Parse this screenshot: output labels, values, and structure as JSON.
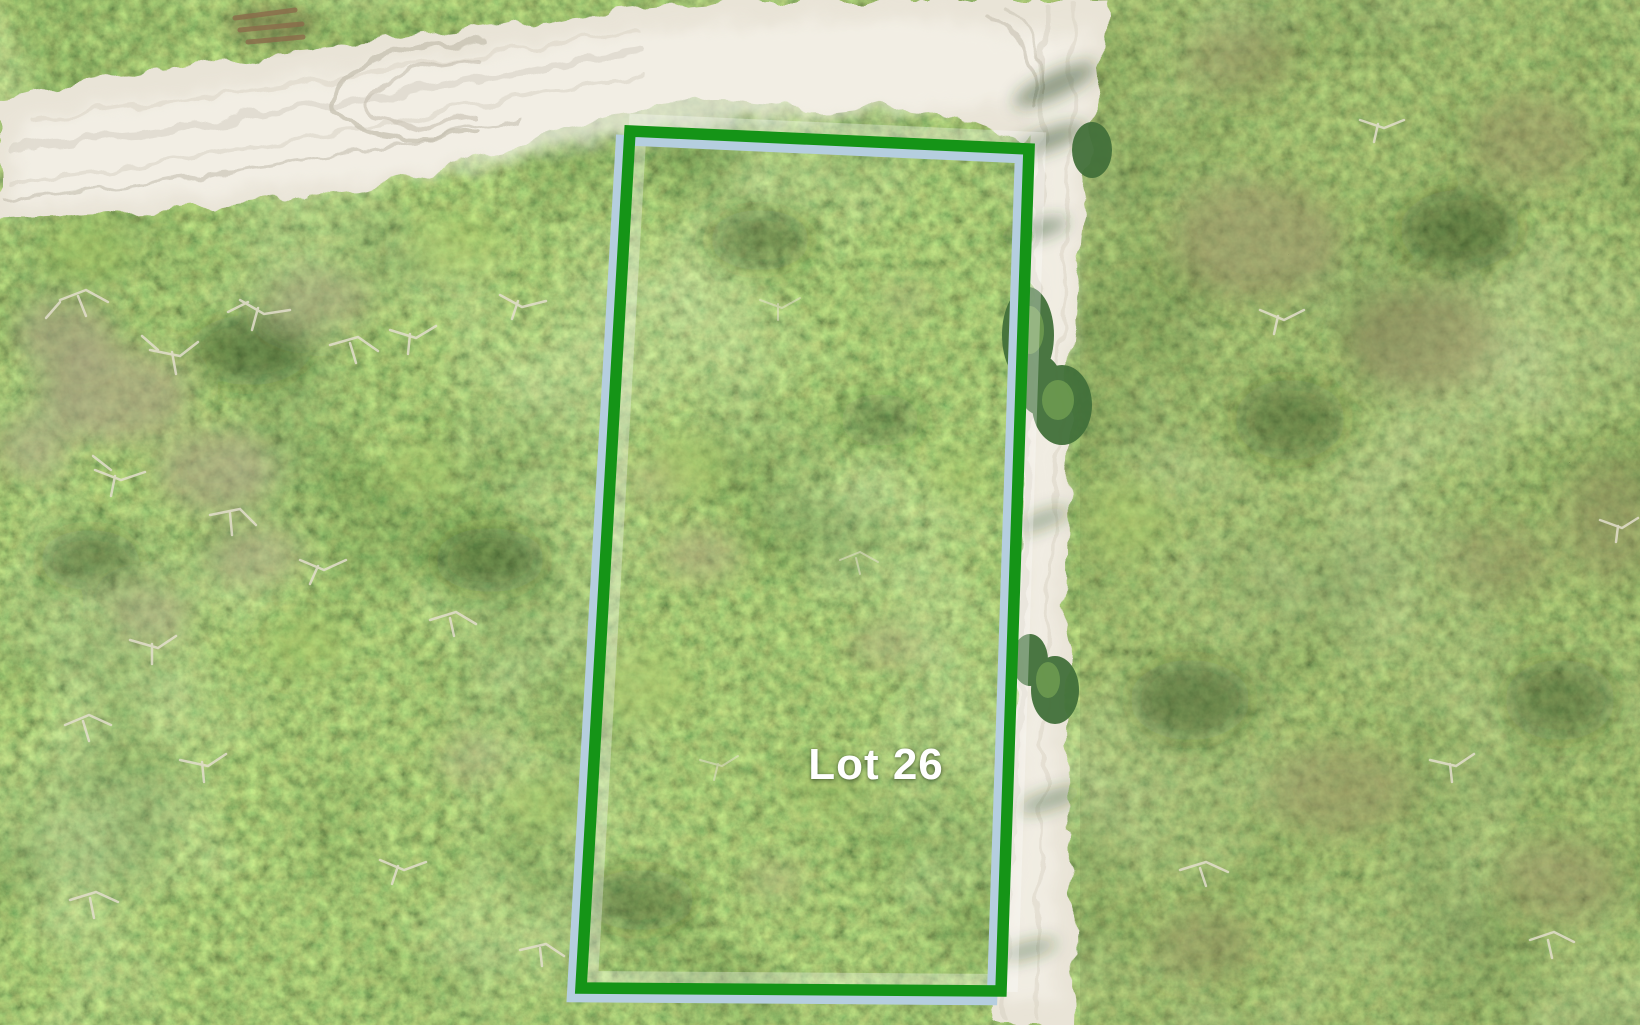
{
  "scene": {
    "kind": "aerial-drone-photo-of-wooded-lot",
    "lot_label": "Lot 26",
    "colors": {
      "boundary_outer": "#159417",
      "boundary_inner": "#b5cedf",
      "boundary_halo": "#ffffff",
      "label_text": "#ffffff",
      "canopy_base": "#4f7c3c",
      "road_sand": "#e9e4d7"
    }
  }
}
